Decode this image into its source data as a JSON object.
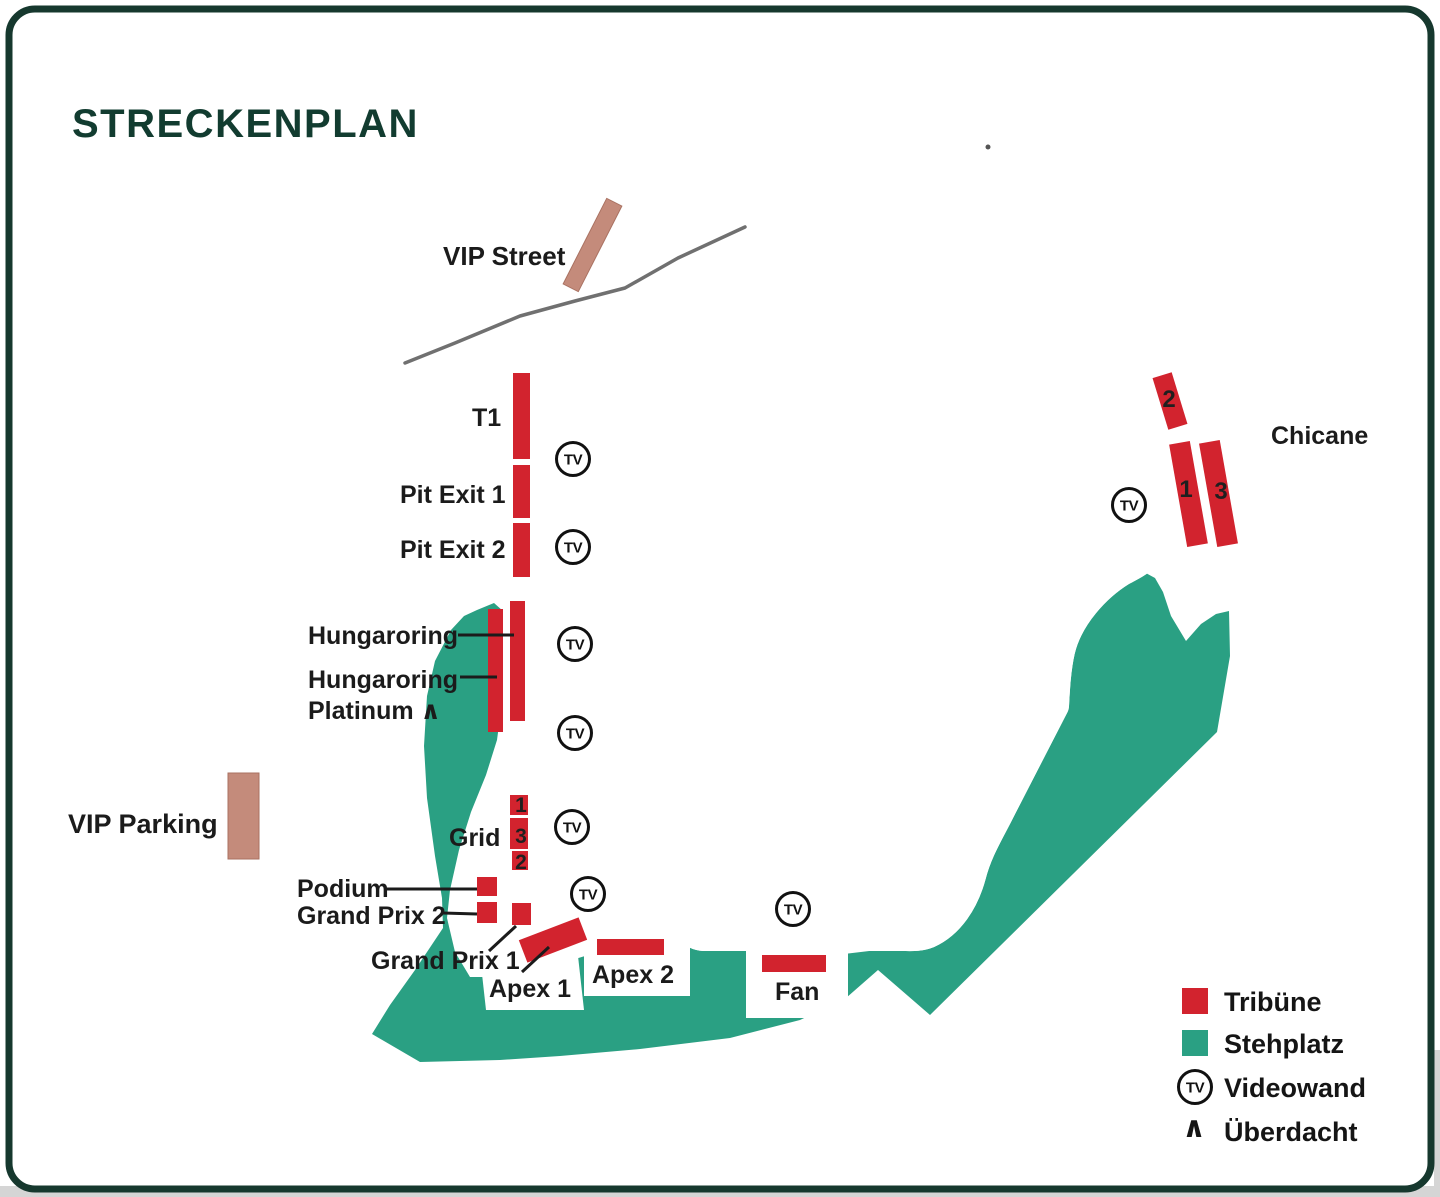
{
  "title": "STRECKENPLAN",
  "colors": {
    "tribune_red": "#d2232e",
    "stehplatz_green": "#2aa083",
    "vip_salmon": "#c48b7b",
    "vip_salmon_border": "#aa7262",
    "track_gray": "#8d8d8d",
    "road_gray": "#707070",
    "frame_green": "#16382e",
    "title_green": "#123c30",
    "label_black": "#1b1b1b"
  },
  "map": {
    "tv_icon_text": "TV",
    "tv_positions": [
      {
        "x": 573,
        "y": 459
      },
      {
        "x": 573,
        "y": 547
      },
      {
        "x": 575,
        "y": 644
      },
      {
        "x": 575,
        "y": 733
      },
      {
        "x": 572,
        "y": 827
      },
      {
        "x": 588,
        "y": 894
      },
      {
        "x": 793,
        "y": 909
      },
      {
        "x": 1129,
        "y": 505
      }
    ],
    "labels": [
      {
        "id": "vip-street",
        "text": "VIP Street",
        "x": 443,
        "y": 265,
        "size": 26
      },
      {
        "id": "t1",
        "text": "T1",
        "x": 472,
        "y": 426,
        "size": 25
      },
      {
        "id": "pit-exit-1",
        "text": "Pit Exit 1",
        "x": 400,
        "y": 503,
        "size": 25
      },
      {
        "id": "pit-exit-2",
        "text": "Pit Exit 2",
        "x": 400,
        "y": 558,
        "size": 25
      },
      {
        "id": "hungaroring",
        "text": "Hungaroring",
        "x": 308,
        "y": 644,
        "size": 25
      },
      {
        "id": "hungaroring-platinum-line1",
        "text": "Hungaroring",
        "x": 308,
        "y": 688,
        "size": 25
      },
      {
        "id": "hungaroring-platinum-line2",
        "text": "Platinum ∧",
        "x": 308,
        "y": 719,
        "size": 25
      },
      {
        "id": "vip-parking",
        "text": "VIP Parking",
        "x": 68,
        "y": 833,
        "size": 27
      },
      {
        "id": "grid",
        "text": "Grid",
        "x": 449,
        "y": 846,
        "size": 25
      },
      {
        "id": "podium",
        "text": "Podium",
        "x": 297,
        "y": 897,
        "size": 25
      },
      {
        "id": "grand-prix-2",
        "text": "Grand Prix 2",
        "x": 297,
        "y": 924,
        "size": 25
      },
      {
        "id": "grand-prix-1",
        "text": "Grand Prix 1",
        "x": 371,
        "y": 969,
        "size": 25
      },
      {
        "id": "apex-1",
        "text": "Apex 1",
        "x": 489,
        "y": 997,
        "size": 25
      },
      {
        "id": "apex-2",
        "text": "Apex 2",
        "x": 592,
        "y": 983,
        "size": 25
      },
      {
        "id": "fan",
        "text": "Fan",
        "x": 775,
        "y": 1000,
        "size": 25
      },
      {
        "id": "chicane",
        "text": "Chicane",
        "x": 1271,
        "y": 444,
        "size": 25
      }
    ],
    "pointer_lines": [
      {
        "x1": 458,
        "y1": 635,
        "x2": 514,
        "y2": 635
      },
      {
        "x1": 460,
        "y1": 677,
        "x2": 497,
        "y2": 677
      },
      {
        "x1": 386,
        "y1": 889,
        "x2": 477,
        "y2": 889
      },
      {
        "x1": 443,
        "y1": 913,
        "x2": 477,
        "y2": 914
      },
      {
        "x1": 489,
        "y1": 951,
        "x2": 516,
        "y2": 926
      },
      {
        "x1": 522,
        "y1": 972,
        "x2": 549,
        "y2": 947
      }
    ],
    "grandstands": [
      {
        "id": "t1",
        "x": 513,
        "y": 373,
        "w": 17,
        "h": 86
      },
      {
        "id": "pit-exit-1",
        "x": 513,
        "y": 465,
        "w": 17,
        "h": 53
      },
      {
        "id": "pit-exit-2",
        "x": 513,
        "y": 523,
        "w": 17,
        "h": 54
      },
      {
        "id": "hungaroring-platinum",
        "x": 488,
        "y": 609,
        "w": 15,
        "h": 123
      },
      {
        "id": "hungaroring",
        "x": 510,
        "y": 601,
        "w": 15,
        "h": 120
      },
      {
        "id": "grid-1",
        "x": 510,
        "y": 795,
        "w": 18,
        "h": 20
      },
      {
        "id": "grid-3",
        "x": 510,
        "y": 818,
        "w": 18,
        "h": 31
      },
      {
        "id": "grid-2",
        "x": 512,
        "y": 851,
        "w": 16,
        "h": 19
      },
      {
        "id": "podium",
        "x": 477,
        "y": 877,
        "w": 20,
        "h": 19
      },
      {
        "id": "grand-prix-2",
        "x": 477,
        "y": 902,
        "w": 20,
        "h": 21
      },
      {
        "id": "grand-prix-1",
        "x": 512,
        "y": 903,
        "w": 19,
        "h": 22
      },
      {
        "id": "apex-1",
        "x": 521,
        "y": 928,
        "w": 64,
        "h": 24,
        "rot": -21
      },
      {
        "id": "apex-2",
        "x": 597,
        "y": 939,
        "w": 67,
        "h": 16
      },
      {
        "id": "fan",
        "x": 762,
        "y": 955,
        "w": 64,
        "h": 17
      },
      {
        "id": "chicane-2",
        "x": 1160,
        "y": 374,
        "w": 20,
        "h": 54,
        "rot": -17
      },
      {
        "id": "chicane-1",
        "x": 1178,
        "y": 442,
        "w": 21,
        "h": 104,
        "rot": -10
      },
      {
        "id": "chicane-3",
        "x": 1208,
        "y": 441,
        "w": 21,
        "h": 105,
        "rot": -10
      }
    ],
    "stand_numbers": [
      {
        "text": "1",
        "x": 521,
        "y": 812,
        "size": 21
      },
      {
        "text": "3",
        "x": 521,
        "y": 843,
        "size": 21
      },
      {
        "text": "2",
        "x": 521,
        "y": 869,
        "size": 21
      },
      {
        "text": "2",
        "x": 1169,
        "y": 407,
        "size": 24
      },
      {
        "text": "1",
        "x": 1186,
        "y": 497,
        "size": 24
      },
      {
        "text": "3",
        "x": 1221,
        "y": 499,
        "size": 24
      }
    ],
    "vip_areas": [
      {
        "id": "vip-street-road",
        "x": 584,
        "y": 197,
        "w": 17,
        "h": 96,
        "rot": 27
      },
      {
        "id": "vip-parking-lot",
        "x": 228,
        "y": 773,
        "w": 31,
        "h": 86,
        "rot": 0
      }
    ]
  },
  "legend": {
    "items": [
      {
        "id": "tribune",
        "label": "Tribüne"
      },
      {
        "id": "stehplatz",
        "label": "Stehplatz"
      },
      {
        "id": "videowand",
        "label": "Videowand"
      },
      {
        "id": "ueberdacht",
        "label": "Überdacht"
      }
    ],
    "covered_symbol": "∧"
  }
}
